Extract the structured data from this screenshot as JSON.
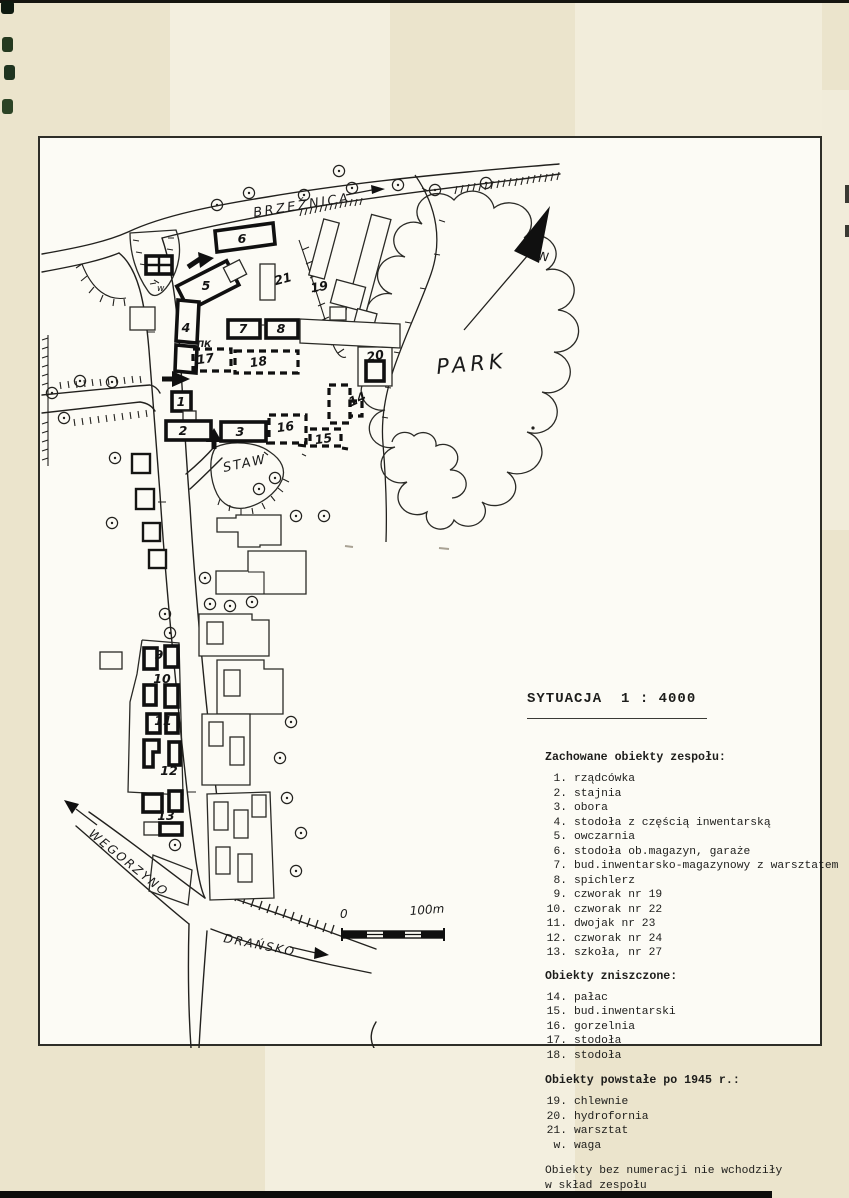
{
  "title": "SYTUACJA  1 : 4000",
  "legend": {
    "preserved": {
      "heading": "Zachowane obiekty zespołu:",
      "items": [
        {
          "num": "1.",
          "label": "rządcówka"
        },
        {
          "num": "2.",
          "label": "stajnia"
        },
        {
          "num": "3.",
          "label": "obora"
        },
        {
          "num": "4.",
          "label": "stodoła z częścią inwentarską"
        },
        {
          "num": "5.",
          "label": "owczarnia"
        },
        {
          "num": "6.",
          "label": "stodoła ob.magazyn, garaże"
        },
        {
          "num": "7.",
          "label": "bud.inwentarsko-magazynowy z warsztatem"
        },
        {
          "num": "8.",
          "label": "spichlerz"
        },
        {
          "num": "9.",
          "label": "czworak nr 19"
        },
        {
          "num": "10.",
          "label": "czworak nr 22"
        },
        {
          "num": "11.",
          "label": "dwojak nr 23"
        },
        {
          "num": "12.",
          "label": "czworak nr 24"
        },
        {
          "num": "13.",
          "label": "szkoła, nr 27"
        }
      ]
    },
    "destroyed": {
      "heading": "Obiekty zniszczone:",
      "items": [
        {
          "num": "14.",
          "label": "pałac"
        },
        {
          "num": "15.",
          "label": "bud.inwentarski"
        },
        {
          "num": "16.",
          "label": "gorzelnia"
        },
        {
          "num": "17.",
          "label": "stodoła"
        },
        {
          "num": "18.",
          "label": "stodoła"
        }
      ]
    },
    "post1945": {
      "heading": "Obiekty powstałe po 1945 r.:",
      "items": [
        {
          "num": "19.",
          "label": "chlewnie"
        },
        {
          "num": "20.",
          "label": "hydrofornia"
        },
        {
          "num": "21.",
          "label": "warsztat"
        },
        {
          "num": "w.",
          "label": "waga"
        }
      ]
    },
    "note_line1": "Obiekty bez numeracji nie wchodziły",
    "note_line2": "w skład zespołu"
  },
  "map": {
    "street_labels": {
      "brzeznica": "BRZEŹNICA",
      "wegorzyno": "WĘGORZYNO",
      "drawsko": "DRAŃSKO"
    },
    "area_labels": {
      "park": "PARK",
      "staw": "STAW"
    },
    "north_label": "N",
    "scale": {
      "start": "0",
      "end": "100m"
    },
    "small_labels": {
      "pk": "ПК",
      "waga": "w"
    },
    "building_numbers": [
      "1",
      "2",
      "3",
      "4",
      "5",
      "6",
      "7",
      "8",
      "9",
      "10",
      "11",
      "12",
      "13",
      "14",
      "15",
      "16",
      "17",
      "18",
      "19",
      "20",
      "21"
    ]
  },
  "colors": {
    "paper": "#ebe4cc",
    "drawing_sheet": "#fcfbf5",
    "ink": "#1d1d1b"
  }
}
